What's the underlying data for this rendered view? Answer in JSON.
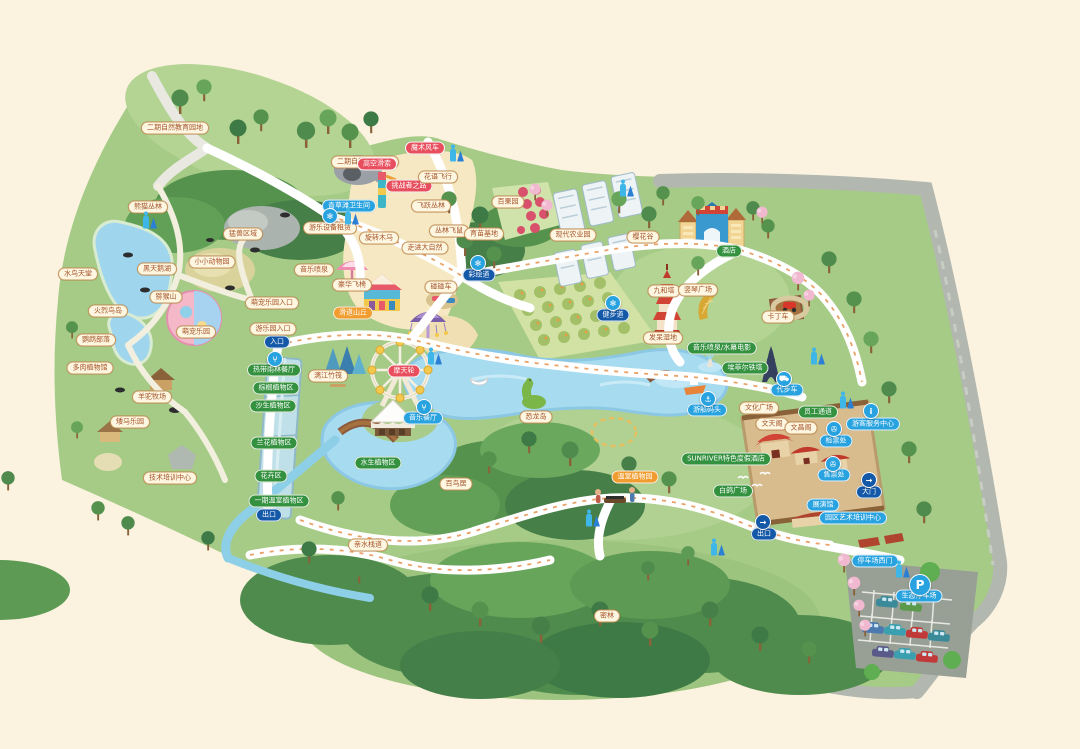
{
  "map": {
    "name": "生态乐园导览图",
    "background_color": "#fbf3e0",
    "colors": {
      "park_green": "#a6cb87",
      "forest_dark": "#3d7a45",
      "lake_blue": "#a7dbf0",
      "sand": "#f6e8c2",
      "road_gray": "#b2b8af",
      "path_white": "#ffffff",
      "badge_tan": "#fdf6e0",
      "badge_red": "#e84f5e",
      "badge_green": "#33913f",
      "badge_blue": "#29a3e0",
      "badge_navy": "#1459a8",
      "badge_orange": "#f09c2e"
    },
    "labels": [
      {
        "text": "二期自然教育园地",
        "x": 175,
        "y": 128,
        "style": "tan"
      },
      {
        "text": "二期自然教育园地",
        "x": 365,
        "y": 162,
        "style": "tan"
      },
      {
        "text": "熊猫丛林",
        "x": 148,
        "y": 207,
        "style": "tan"
      },
      {
        "text": "猛兽区域",
        "x": 243,
        "y": 234,
        "style": "tan"
      },
      {
        "text": "小小动物园",
        "x": 212,
        "y": 262,
        "style": "tan"
      },
      {
        "text": "水鸟天堂",
        "x": 78,
        "y": 274,
        "style": "tan"
      },
      {
        "text": "黑天鹅湖",
        "x": 157,
        "y": 269,
        "style": "tan"
      },
      {
        "text": "猕猴山",
        "x": 166,
        "y": 297,
        "style": "tan"
      },
      {
        "text": "火烈鸟岛",
        "x": 108,
        "y": 311,
        "style": "tan"
      },
      {
        "text": "鹦鹉部落",
        "x": 96,
        "y": 340,
        "style": "tan"
      },
      {
        "text": "多肉植物馆",
        "x": 90,
        "y": 368,
        "style": "tan"
      },
      {
        "text": "羊驼牧场",
        "x": 152,
        "y": 397,
        "style": "tan"
      },
      {
        "text": "矮马乐园",
        "x": 130,
        "y": 422,
        "style": "tan"
      },
      {
        "text": "技术培训中心",
        "x": 170,
        "y": 478,
        "style": "tan"
      },
      {
        "text": "萌宠乐园",
        "x": 196,
        "y": 332,
        "style": "tan"
      },
      {
        "text": "萌宠乐园入口",
        "x": 272,
        "y": 303,
        "style": "tan"
      },
      {
        "text": "游乐园入口",
        "x": 273,
        "y": 329,
        "style": "tan"
      },
      {
        "text": "入口",
        "x": 277,
        "y": 342,
        "style": "navy"
      },
      {
        "text": "青草滩卫生间",
        "x": 349,
        "y": 206,
        "style": "blue"
      },
      {
        "text": "高空滑索",
        "x": 377,
        "y": 164,
        "style": "red"
      },
      {
        "text": "魔术风车",
        "x": 425,
        "y": 148,
        "style": "red"
      },
      {
        "text": "挑战者之路",
        "x": 409,
        "y": 186,
        "style": "red"
      },
      {
        "text": "花语飞行",
        "x": 438,
        "y": 177,
        "style": "tan"
      },
      {
        "text": "飞跃丛林",
        "x": 431,
        "y": 206,
        "style": "tan"
      },
      {
        "text": "丛林飞鼠",
        "x": 449,
        "y": 231,
        "style": "tan"
      },
      {
        "text": "游乐设备租赁",
        "x": 330,
        "y": 228,
        "style": "tan"
      },
      {
        "text": "旋转木马",
        "x": 379,
        "y": 238,
        "style": "tan"
      },
      {
        "text": "走进大自然",
        "x": 425,
        "y": 248,
        "style": "tan"
      },
      {
        "text": "豪华飞椅",
        "x": 352,
        "y": 285,
        "style": "tan"
      },
      {
        "text": "碰碰车",
        "x": 441,
        "y": 287,
        "style": "tan"
      },
      {
        "text": "音乐喷泉",
        "x": 314,
        "y": 270,
        "style": "tan"
      },
      {
        "text": "滑道山丘",
        "x": 353,
        "y": 313,
        "style": "orange"
      },
      {
        "text": "漓江竹筏",
        "x": 328,
        "y": 376,
        "style": "tan"
      },
      {
        "text": "摩天轮",
        "x": 404,
        "y": 371,
        "style": "red"
      },
      {
        "text": "音乐餐厅",
        "x": 423,
        "y": 418,
        "style": "blue"
      },
      {
        "text": "热带雨林餐厅",
        "x": 274,
        "y": 370,
        "style": "green"
      },
      {
        "text": "棕榈植物区",
        "x": 276,
        "y": 388,
        "style": "green"
      },
      {
        "text": "沙生植物区",
        "x": 273,
        "y": 406,
        "style": "green"
      },
      {
        "text": "兰花植物区",
        "x": 274,
        "y": 443,
        "style": "green"
      },
      {
        "text": "花卉区",
        "x": 271,
        "y": 476,
        "style": "green"
      },
      {
        "text": "一期温室植物区",
        "x": 279,
        "y": 501,
        "style": "green"
      },
      {
        "text": "出口",
        "x": 269,
        "y": 515,
        "style": "navy"
      },
      {
        "text": "水生植物区",
        "x": 378,
        "y": 463,
        "style": "green"
      },
      {
        "text": "恐龙岛",
        "x": 536,
        "y": 417,
        "style": "tan"
      },
      {
        "text": "百鸟居",
        "x": 456,
        "y": 484,
        "style": "tan"
      },
      {
        "text": "亲水栈道",
        "x": 368,
        "y": 545,
        "style": "tan"
      },
      {
        "text": "密林",
        "x": 607,
        "y": 616,
        "style": "tan"
      },
      {
        "text": "百果园",
        "x": 508,
        "y": 202,
        "style": "tan"
      },
      {
        "text": "育苗基地",
        "x": 484,
        "y": 234,
        "style": "tan"
      },
      {
        "text": "现代农业园",
        "x": 573,
        "y": 235,
        "style": "tan"
      },
      {
        "text": "樱花谷",
        "x": 643,
        "y": 237,
        "style": "tan"
      },
      {
        "text": "酒店",
        "x": 729,
        "y": 251,
        "style": "green"
      },
      {
        "text": "彩绘道",
        "x": 479,
        "y": 275,
        "style": "navy"
      },
      {
        "text": "健步道",
        "x": 613,
        "y": 315,
        "style": "navy"
      },
      {
        "text": "九和塔",
        "x": 664,
        "y": 291,
        "style": "tan"
      },
      {
        "text": "竖琴广场",
        "x": 698,
        "y": 290,
        "style": "tan"
      },
      {
        "text": "卡丁车",
        "x": 778,
        "y": 317,
        "style": "tan"
      },
      {
        "text": "发呆湿地",
        "x": 663,
        "y": 338,
        "style": "tan"
      },
      {
        "text": "音乐喷泉/水幕电影",
        "x": 722,
        "y": 348,
        "style": "green"
      },
      {
        "text": "埃菲尔铁塔",
        "x": 745,
        "y": 368,
        "style": "green"
      },
      {
        "text": "游船码头",
        "x": 707,
        "y": 410,
        "style": "blue"
      },
      {
        "text": "代步车",
        "x": 787,
        "y": 390,
        "style": "blue"
      },
      {
        "text": "文化广场",
        "x": 759,
        "y": 408,
        "style": "tan"
      },
      {
        "text": "员工通道",
        "x": 818,
        "y": 412,
        "style": "green"
      },
      {
        "text": "文天阁",
        "x": 772,
        "y": 424,
        "style": "tan"
      },
      {
        "text": "文昌阁",
        "x": 801,
        "y": 428,
        "style": "tan"
      },
      {
        "text": "检票处",
        "x": 836,
        "y": 441,
        "style": "blue"
      },
      {
        "text": "售票处",
        "x": 834,
        "y": 475,
        "style": "blue"
      },
      {
        "text": "大门",
        "x": 869,
        "y": 492,
        "style": "navy"
      },
      {
        "text": "游客服务中心",
        "x": 873,
        "y": 424,
        "style": "blue"
      },
      {
        "text": "展演馆",
        "x": 823,
        "y": 505,
        "style": "blue"
      },
      {
        "text": "园区艺术培训中心",
        "x": 853,
        "y": 518,
        "style": "blue"
      },
      {
        "text": "白鸽广场",
        "x": 733,
        "y": 491,
        "style": "green"
      },
      {
        "text": "SUNRIVER特色度假酒店",
        "x": 726,
        "y": 459,
        "style": "green"
      },
      {
        "text": "温室植物园",
        "x": 635,
        "y": 477,
        "style": "orange"
      },
      {
        "text": "出口",
        "x": 764,
        "y": 534,
        "style": "navy"
      },
      {
        "text": "停车场西门",
        "x": 875,
        "y": 561,
        "style": "blue"
      },
      {
        "text": "生态停车场",
        "x": 919,
        "y": 596,
        "style": "blue"
      }
    ],
    "icons": [
      {
        "glyph": "restroom",
        "x": 150,
        "y": 222
      },
      {
        "glyph": "restroom",
        "x": 352,
        "y": 218
      },
      {
        "glyph": "restroom",
        "x": 457,
        "y": 155
      },
      {
        "glyph": "restroom",
        "x": 627,
        "y": 190
      },
      {
        "glyph": "restroom",
        "x": 435,
        "y": 358
      },
      {
        "glyph": "restroom",
        "x": 818,
        "y": 358
      },
      {
        "glyph": "restroom",
        "x": 847,
        "y": 402
      },
      {
        "glyph": "restroom",
        "x": 593,
        "y": 520
      },
      {
        "glyph": "restroom",
        "x": 718,
        "y": 549
      },
      {
        "glyph": "restroom",
        "x": 903,
        "y": 571
      },
      {
        "glyph": "restaurant",
        "x": 275,
        "y": 359
      },
      {
        "glyph": "restaurant",
        "x": 424,
        "y": 407
      },
      {
        "glyph": "scenic-spot",
        "x": 330,
        "y": 216
      },
      {
        "glyph": "scenic-spot",
        "x": 478,
        "y": 263
      },
      {
        "glyph": "scenic-spot",
        "x": 613,
        "y": 303
      },
      {
        "glyph": "boat-dock",
        "x": 708,
        "y": 399
      },
      {
        "glyph": "sightseeing-cart",
        "x": 784,
        "y": 379
      },
      {
        "glyph": "ticket",
        "x": 834,
        "y": 429
      },
      {
        "glyph": "ticket",
        "x": 833,
        "y": 464
      },
      {
        "glyph": "exit",
        "x": 869,
        "y": 480
      },
      {
        "glyph": "exit",
        "x": 763,
        "y": 522
      },
      {
        "glyph": "info",
        "x": 871,
        "y": 411
      },
      {
        "glyph": "parking",
        "x": 920,
        "y": 585
      }
    ]
  }
}
